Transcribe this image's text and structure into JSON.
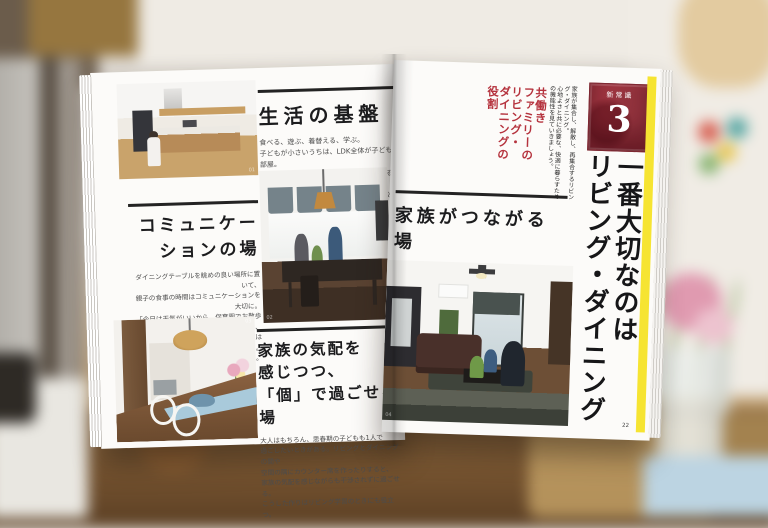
{
  "magazine": {
    "left_page": {
      "sections": [
        {
          "title": "生活の基盤",
          "body": "食べる、遊ぶ、着替える、学ぶ。\n子どもが小さいうちは、LDK全体が子ども部屋。\n物が多くなって片づかないとイライラするよりも、\n子どもに生活の基盤を教える大切な時間と考えて、\n暮らしの機能を充実させたい。"
        },
        {
          "title": "コミュニケー\nションの場",
          "body": "ダイニングテーブルを眺めの良い場所に置いて、\n親子の食事の時間はコミュニケーションを大切に。\n「今日は天気がいいから、保育園でお散歩行くかもね」、\n「晴れているみたいだけど、新しい図鑑は楽しいの?」。\n親子、夫婦で会話を交わす貴重な時間。"
        },
        {
          "title": "家族の気配を\n感じつつ、\n「個」で過ごせる場",
          "body": "大人はもちろん、思春期の子どもも1人で\n過ごしたいときがある。リビングとダイニングの間や\n空間の隅にカウンター席を作ったりすると、\n家族の気配を感じながらも干渉されずに過ごせる。\nこうした作りはリビング学習のときにも役立つ。"
        }
      ],
      "photo_captions": [
        "01",
        "02",
        "03"
      ]
    },
    "right_page": {
      "kicker": "共働き\nファミリーの\nリビング・\nダイニングの\n役割",
      "badge": {
        "label": "新常識",
        "number": "3"
      },
      "intro": "家族が集合し、解散し、再集合するリビング・ダイニング。\n心地よさと共に必要な、快適に暮らすための機能性を見ていきましょう。",
      "section": {
        "title": "家族がつながる場",
        "body": "リビングは家族が集合して、つながりを確認する場。\n朝は「今日もがんばろうね!」と\nエールを送り合って、会社へ、学校へ、保育園へ、\nそれぞれの場に出かけていく。"
      },
      "main_title": "一番大切なのは\nリビング・ダイニング",
      "page_number": "22",
      "photo_caption": "04"
    },
    "colors": {
      "accent_red": "#b5333e",
      "badge_red": "#9e3540",
      "highlight_yellow": "#f6e432",
      "heading_black": "#1c1c1e",
      "body_gray": "#4c4c4c"
    }
  }
}
